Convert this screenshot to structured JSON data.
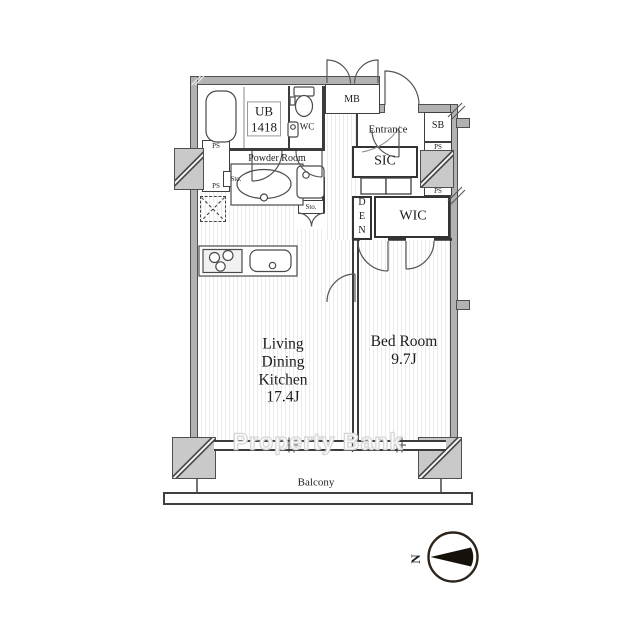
{
  "floorplan": {
    "watermark": "Property Bank",
    "rooms": {
      "ub": "UB\n1418",
      "wc": "WC",
      "mb": "MB",
      "entrance": "Entrance",
      "sb": "SB",
      "powder_room": "Powder Room",
      "sic": "SIC",
      "den": "DEN",
      "wic": "WIC",
      "ldk": "Living\nDining\nKitchen\n17.4J",
      "bedroom": "Bed Room\n9.7J",
      "balcony": "Balcony"
    },
    "labels": {
      "ps": "PS",
      "sto": "Sto.",
      "north": "N"
    },
    "colors": {
      "wall_fill": "#b2b2b2",
      "wall_outline": "#4f4f4f",
      "pillar_fill": "#c9c9c9",
      "line": "#3c3c3c",
      "floor_stripe": "#ebebeb",
      "watermark_text": "#ffffff",
      "watermark_outline": "#d6d6d6"
    }
  }
}
